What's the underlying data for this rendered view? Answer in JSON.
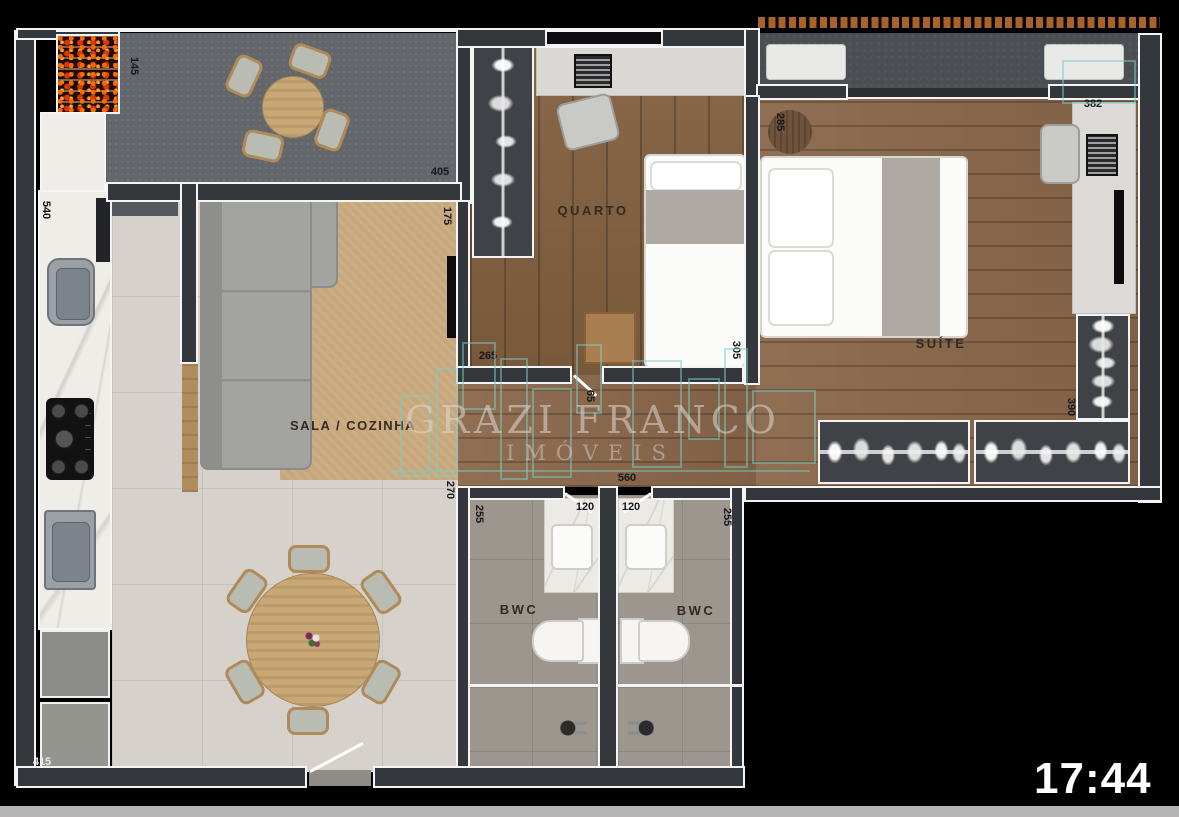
{
  "clock": {
    "time": "17:44"
  },
  "watermark": {
    "brand": "GRAZI FRANCO",
    "subtitle": "IMÓVEIS"
  },
  "rooms": {
    "bedroom": {
      "label": "QUARTO"
    },
    "suite": {
      "label": "SUÍTE"
    },
    "living_kitchen": {
      "label": "SALA / COZINHA"
    },
    "bathroom_1": {
      "label": "BWC"
    },
    "bathroom_2": {
      "label": "BWC"
    }
  },
  "dimensions_cm": [
    {
      "id": "terrace-grill",
      "value": "145"
    },
    {
      "id": "terrace-length",
      "value": "405"
    },
    {
      "id": "living-top",
      "value": "175"
    },
    {
      "id": "kitchen-counter",
      "value": "540"
    },
    {
      "id": "living-right",
      "value": "270"
    },
    {
      "id": "kitchen-bottom",
      "value": "415"
    },
    {
      "id": "bedroom-width",
      "value": "265"
    },
    {
      "id": "bedroom-depth",
      "value": "305"
    },
    {
      "id": "hall-door",
      "value": "65"
    },
    {
      "id": "hall-width",
      "value": "560"
    },
    {
      "id": "suite-left-depth",
      "value": "285"
    },
    {
      "id": "suite-width",
      "value": "382"
    },
    {
      "id": "suite-right-depth",
      "value": "390"
    },
    {
      "id": "bath1-depth",
      "value": "255"
    },
    {
      "id": "bath1-width",
      "value": "120"
    },
    {
      "id": "bath2-width",
      "value": "120"
    },
    {
      "id": "bath2-depth",
      "value": "255"
    }
  ],
  "colors": {
    "wall_fill": "#34373c",
    "wall_outline": "#f4f4f4",
    "wood_floor": "#82603f",
    "tile_floor": "#d6d2cb",
    "bath_floor": "#9c968f",
    "terrace_floor": "#63666a",
    "rug": "#c7a87c",
    "watermark_accent": "#7ACEC6",
    "pergola": "#a9622a",
    "clock_text": "#ffffff"
  }
}
